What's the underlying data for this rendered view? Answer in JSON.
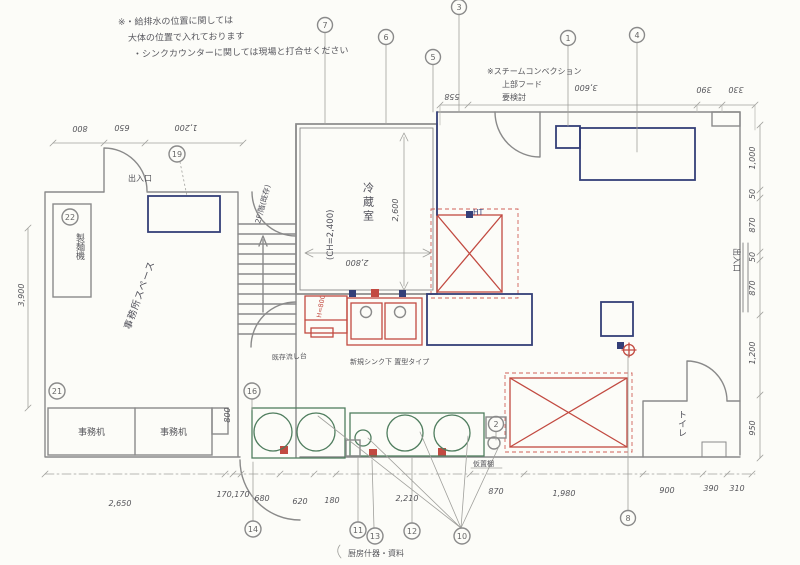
{
  "canvas": {
    "width": 800,
    "height": 565
  },
  "colors": {
    "pencil": "#8a8a8a",
    "navy": "#343f78",
    "red": "#c24a41",
    "green": "#4f7d5e",
    "paper": "#fcfcf8"
  },
  "notes": {
    "l1": "※・給排水の位置に関しては",
    "l2": "大体の位置で入れております",
    "l3": "・シンクカウンターに関しては現場と打合せください",
    "steam1": "※スチームコンベクション",
    "steam2": "上部フード",
    "steam3": "要検討",
    "bottom": "厨房什器・資料"
  },
  "rooms": {
    "cold": "冷蔵室",
    "ch": "(CH=2,400)",
    "office": "事務所スペース",
    "toilet": "トイレ",
    "stairs": "2F/階(既存)"
  },
  "labels": {
    "entrance_top": "出入口",
    "entrance_right": "出入口",
    "noodle": "製麺機",
    "desk": "事務机",
    "sink_existing": "既存流し台",
    "sink_new": "新規シンク下 置型タイプ",
    "shelf": "仮置棚",
    "ht": "HT",
    "h_note": "H=800"
  },
  "dims": {
    "top_left": [
      "800",
      "650",
      "1,200"
    ],
    "top_right": [
      "558",
      "3,600",
      "390",
      "330"
    ],
    "right": [
      "1,000",
      "50",
      "870",
      "50",
      "870",
      "1,200",
      "950"
    ],
    "left": [
      "3,900"
    ],
    "bottom": [
      "2,650",
      "170,170",
      "680",
      "620",
      "180",
      "2,210",
      "870",
      "1,980",
      "900",
      "390",
      "310"
    ],
    "cold_w": "2,800",
    "cold_h": "2,600",
    "desk_side": "800"
  },
  "refs": {
    "c1": "1",
    "c2": "2",
    "c3": "3",
    "c4": "4",
    "c5": "5",
    "c6": "6",
    "c7": "7",
    "c8": "8",
    "c10": "10",
    "c11": "11",
    "c12": "12",
    "c13": "13",
    "c14": "14",
    "c16": "16",
    "c19": "19",
    "c21": "21",
    "c22": "22"
  }
}
